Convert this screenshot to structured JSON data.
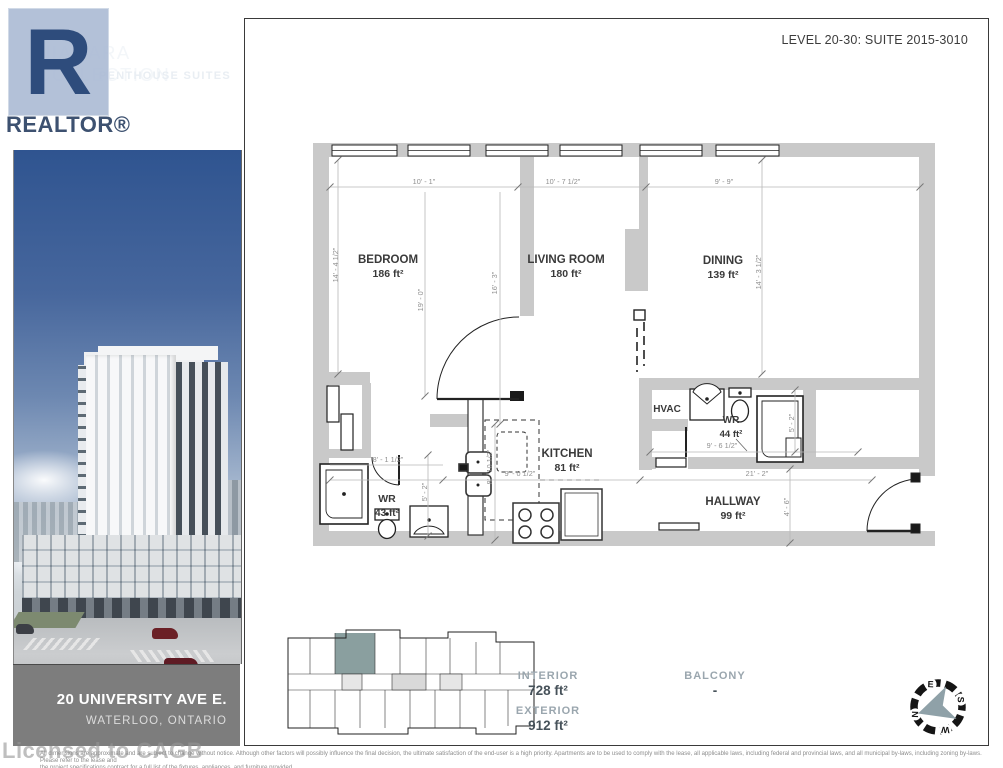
{
  "header": {
    "collection_title": "NIAGARA COLLECTION",
    "collection_subtitle": "PENTHOUSE SUITES",
    "suite_code": "A17",
    "realtor_logo_letter": "R",
    "realtor_logo_text": "REALTOR®",
    "level_suite_line": "LEVEL 20-30:  SUITE 2015-3010"
  },
  "address": {
    "line1": "20 UNIVERSITY AVE E.",
    "line2": "WATERLOO, ONTARIO"
  },
  "floorplan": {
    "rooms": {
      "bedroom": {
        "name": "BEDROOM",
        "area": "186 ft²"
      },
      "living": {
        "name": "LIVING ROOM",
        "area": "180 ft²"
      },
      "dining": {
        "name": "DINING",
        "area": "139 ft²"
      },
      "kitchen": {
        "name": "KITCHEN",
        "area": "81 ft²"
      },
      "hvac": {
        "name": "HVAC"
      },
      "wr_right": {
        "name": "WR",
        "area": "44 ft²"
      },
      "wr_left": {
        "name": "WR",
        "area": "43 ft²"
      },
      "hallway": {
        "name": "HALLWAY",
        "area": "99 ft²"
      }
    },
    "dims": {
      "bedroom_width": "10' - 1\"",
      "living_width": "10' - 7 1/2\"",
      "dining_width": "9' - 9\"",
      "left_height": "14' - 4 1/2\"",
      "right_height": "14' - 3 1/2\"",
      "bedroom_depth": "19' - 0\"",
      "living_depth": "16' - 3\"",
      "wr_left_width": "8' - 1 1/2\"",
      "wr_left_depth": "5' - 2\"",
      "kitchen_width": "9' - 0 1/2\"",
      "kitchen_depth": "8' - 10 1/2\"",
      "wr_right_width": "9' - 6 1/2\"",
      "wr_right_depth": "5' - 2\"",
      "hallway_width": "21' - 2\"",
      "hallway_depth": "4' - 6\""
    }
  },
  "stats": {
    "interior_label": "INTERIOR",
    "interior_value": "728 ft²",
    "exterior_label": "EXTERIOR",
    "exterior_value": "912 ft²",
    "balcony_label": "BALCONY",
    "balcony_value": "-"
  },
  "compass": {
    "north": "N",
    "east": "E",
    "south": "S",
    "west": "W"
  },
  "watermark": "Licensed to CAGB",
  "disclaimer_line1": "All dimensions are approximate and are subject to change without notice. Although other factors will possibly influence the final decision, the ultimate satisfaction of the end-user is a high priority. Apartments are to be used to comply with the lease, all applicable laws, including federal and provincial laws, and all municipal by-laws, including zoning by-laws. Please refer to the lease and",
  "disclaimer_line2": "the project specifications contract for a full list of the fixtures, appliances, and furniture provided.",
  "colors": {
    "accent_blue": "#4a6ba1",
    "wall_gray": "#c9c9c9",
    "keyplan_highlight": "#8a9f9f",
    "stats_label": "#9aa6ae",
    "stats_value": "#47525a"
  }
}
